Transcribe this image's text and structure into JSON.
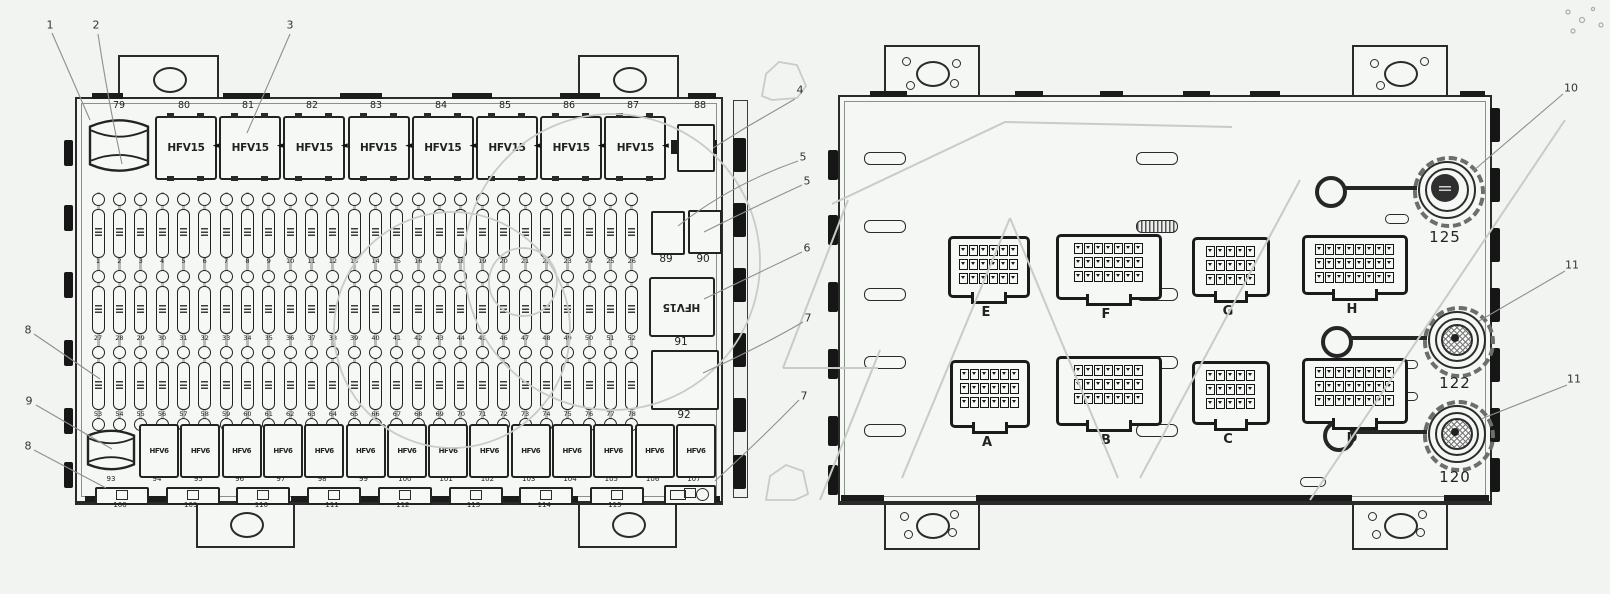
{
  "colors": {
    "line": "#2a2a2a",
    "leader": "#8d918d",
    "watermark": "#c7ccc7",
    "background": "#f1f4f1"
  },
  "left_panel": {
    "top_numbers": [
      "79",
      "80",
      "81",
      "82",
      "83",
      "84",
      "85",
      "86",
      "87",
      "88"
    ],
    "top_relay_label": "HFV15",
    "top_relay_count": 8,
    "side_column": {
      "box1_label": "89",
      "box2_label": "90",
      "relay_label": "HFV15",
      "relay_number": "91",
      "blank_box_number": "92"
    },
    "fuse_rows": [
      {
        "positions": [
          "1",
          "2",
          "3",
          "4",
          "5",
          "6",
          "7",
          "8",
          "9",
          "10",
          "11",
          "12",
          "13",
          "14",
          "15",
          "16",
          "17",
          "18",
          "19",
          "20",
          "21",
          "22",
          "23",
          "24",
          "25",
          "26"
        ]
      },
      {
        "positions": [
          "27",
          "28",
          "29",
          "30",
          "31",
          "32",
          "33",
          "34",
          "35",
          "36",
          "37",
          "38",
          "39",
          "40",
          "41",
          "42",
          "43",
          "44",
          "45",
          "46",
          "47",
          "48",
          "49",
          "50",
          "51",
          "52"
        ]
      },
      {
        "positions": [
          "53",
          "54",
          "55",
          "56",
          "57",
          "58",
          "59",
          "60",
          "61",
          "62",
          "63",
          "64",
          "65",
          "66",
          "67",
          "68",
          "69",
          "70",
          "71",
          "72",
          "73",
          "74",
          "75",
          "76",
          "77",
          "78"
        ]
      }
    ],
    "bottom_relay_label": "HFV6",
    "bottom_cylinder_number": "93",
    "bottom_numbers": [
      "94",
      "95",
      "96",
      "97",
      "98",
      "99",
      "100",
      "101",
      "102",
      "103",
      "104",
      "105",
      "106",
      "107"
    ],
    "slot_numbers": [
      "108",
      "109",
      "110",
      "111",
      "112",
      "113",
      "114",
      "115"
    ]
  },
  "right_panel": {
    "connectors": [
      {
        "label": "E",
        "x": 948,
        "y": 236,
        "w": 76,
        "h": 56,
        "cols": 6
      },
      {
        "label": "F",
        "x": 1056,
        "y": 234,
        "w": 100,
        "h": 60,
        "cols": 7
      },
      {
        "label": "G",
        "x": 1192,
        "y": 237,
        "w": 72,
        "h": 54,
        "cols": 5
      },
      {
        "label": "H",
        "x": 1302,
        "y": 235,
        "w": 100,
        "h": 54,
        "cols": 8
      },
      {
        "label": "A",
        "x": 950,
        "y": 360,
        "w": 74,
        "h": 62,
        "cols": 6
      },
      {
        "label": "B",
        "x": 1056,
        "y": 356,
        "w": 100,
        "h": 64,
        "cols": 7
      },
      {
        "label": "C",
        "x": 1192,
        "y": 361,
        "w": 72,
        "h": 58,
        "cols": 5
      },
      {
        "label": "D",
        "x": 1302,
        "y": 358,
        "w": 100,
        "h": 60,
        "cols": 8
      }
    ],
    "round_connectors": [
      {
        "label": "125",
        "cx": 1445,
        "cy": 188,
        "ring_cx": 1327,
        "variant": "dark",
        "label_y": 228
      },
      {
        "label": "122",
        "cx": 1455,
        "cy": 338,
        "ring_cx": 1333,
        "variant": "hatch",
        "label_y": 374
      },
      {
        "label": "120",
        "cx": 1455,
        "cy": 432,
        "ring_cx": 1335,
        "variant": "hatch",
        "label_y": 468
      }
    ]
  },
  "callouts": [
    {
      "n": "1",
      "x": 50,
      "y": 25,
      "d": "M52,33 L90,120"
    },
    {
      "n": "2",
      "x": 96,
      "y": 25,
      "d": "M98,34 Q108,100 122,164"
    },
    {
      "n": "3",
      "x": 290,
      "y": 25,
      "d": "M290,34 L247,133"
    },
    {
      "n": "4",
      "x": 800,
      "y": 90,
      "d": "M795,99 L745,128 L713,148"
    },
    {
      "n": "5",
      "x": 803,
      "y": 157,
      "d": "M798,161 Q730,185 678,226"
    },
    {
      "n": "5",
      "x": 807,
      "y": 181,
      "d": "M802,185 Q748,210 704,232"
    },
    {
      "n": "6",
      "x": 807,
      "y": 248,
      "d": "M802,252 Q760,272 704,299"
    },
    {
      "n": "7",
      "x": 808,
      "y": 318,
      "d": "M803,322 Q762,346 703,373"
    },
    {
      "n": "7",
      "x": 804,
      "y": 396,
      "d": "M799,400 Q760,440 715,481"
    },
    {
      "n": "8",
      "x": 28,
      "y": 330,
      "d": "M34,334 L100,379"
    },
    {
      "n": "9",
      "x": 29,
      "y": 401,
      "d": "M36,405 L112,449"
    },
    {
      "n": "8",
      "x": 28,
      "y": 446,
      "d": "M34,450 L106,488"
    },
    {
      "n": "10",
      "x": 1571,
      "y": 88,
      "d": "M1563,94 L1473,171"
    },
    {
      "n": "11",
      "x": 1572,
      "y": 265,
      "d": "M1565,271 L1479,321"
    },
    {
      "n": "11",
      "x": 1574,
      "y": 379,
      "d": "M1567,385 L1481,419"
    }
  ],
  "watermark": {
    "circles": [
      [
        452,
        330,
        118
      ],
      [
        612,
        262,
        148
      ],
      [
        523,
        282,
        34
      ]
    ],
    "lines": [
      [
        848,
        200,
        783,
        368
      ],
      [
        783,
        368,
        878,
        368
      ],
      [
        832,
        204,
        1005,
        122
      ],
      [
        1005,
        122,
        1232,
        127
      ],
      [
        902,
        478,
        1010,
        218
      ],
      [
        1010,
        218,
        1118,
        478
      ],
      [
        1140,
        478,
        1300,
        180
      ],
      [
        1310,
        500,
        1565,
        120
      ],
      [
        820,
        500,
        880,
        350
      ]
    ],
    "polygons": [
      [
        [
          762,
          96
        ],
        [
          766,
          74
        ],
        [
          779,
          62
        ],
        [
          797,
          65
        ],
        [
          806,
          86
        ],
        [
          797,
          98
        ],
        [
          772,
          100
        ]
      ],
      [
        [
          766,
          500
        ],
        [
          770,
          476
        ],
        [
          786,
          465
        ],
        [
          803,
          471
        ],
        [
          808,
          494
        ],
        [
          795,
          500
        ]
      ]
    ],
    "dots": [
      [
        1568,
        12,
        2
      ],
      [
        1582,
        20,
        2.5
      ],
      [
        1573,
        31,
        2
      ],
      [
        1593,
        9,
        1.6
      ],
      [
        1601,
        25,
        2
      ]
    ]
  }
}
